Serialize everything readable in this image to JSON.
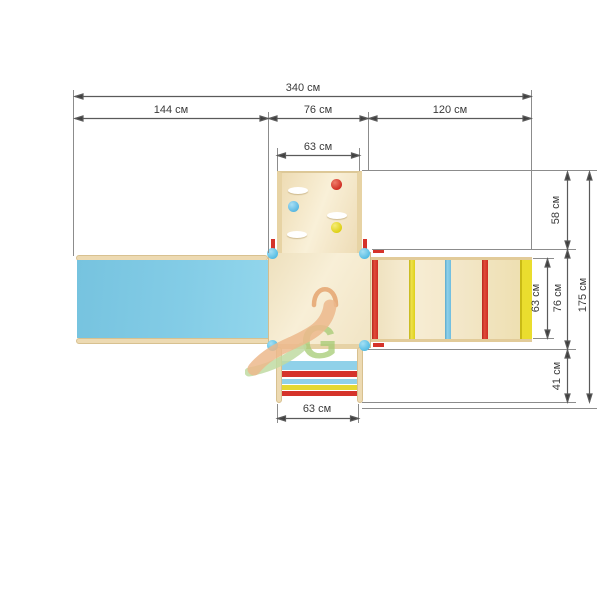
{
  "dimensions": {
    "total_width": "340 см",
    "left_section_width": "144 см",
    "middle_section_width": "76 см",
    "right_section_width": "120 см",
    "climb_wall_width": "63 см",
    "upper_right_height": "58 см",
    "ladder_span_height": "63 см",
    "platform_height": "76 см",
    "lower_right_height": "41 см",
    "total_height": "175 см",
    "stairs_width": "63 см"
  },
  "watermark": {
    "letter_g": "G"
  },
  "colors": {
    "slide_blue": "#7fc8e4",
    "wood_light": "#f6ebd0",
    "wood_border": "#e2cda0",
    "accent_red": "#d5332a",
    "accent_yellow": "#e5d832",
    "accent_blue": "#7cc3e0",
    "stairs_blue": "#90d1e9",
    "post_blue": "#5fc0e6",
    "dim_line_gray": "#5a5a5a"
  }
}
